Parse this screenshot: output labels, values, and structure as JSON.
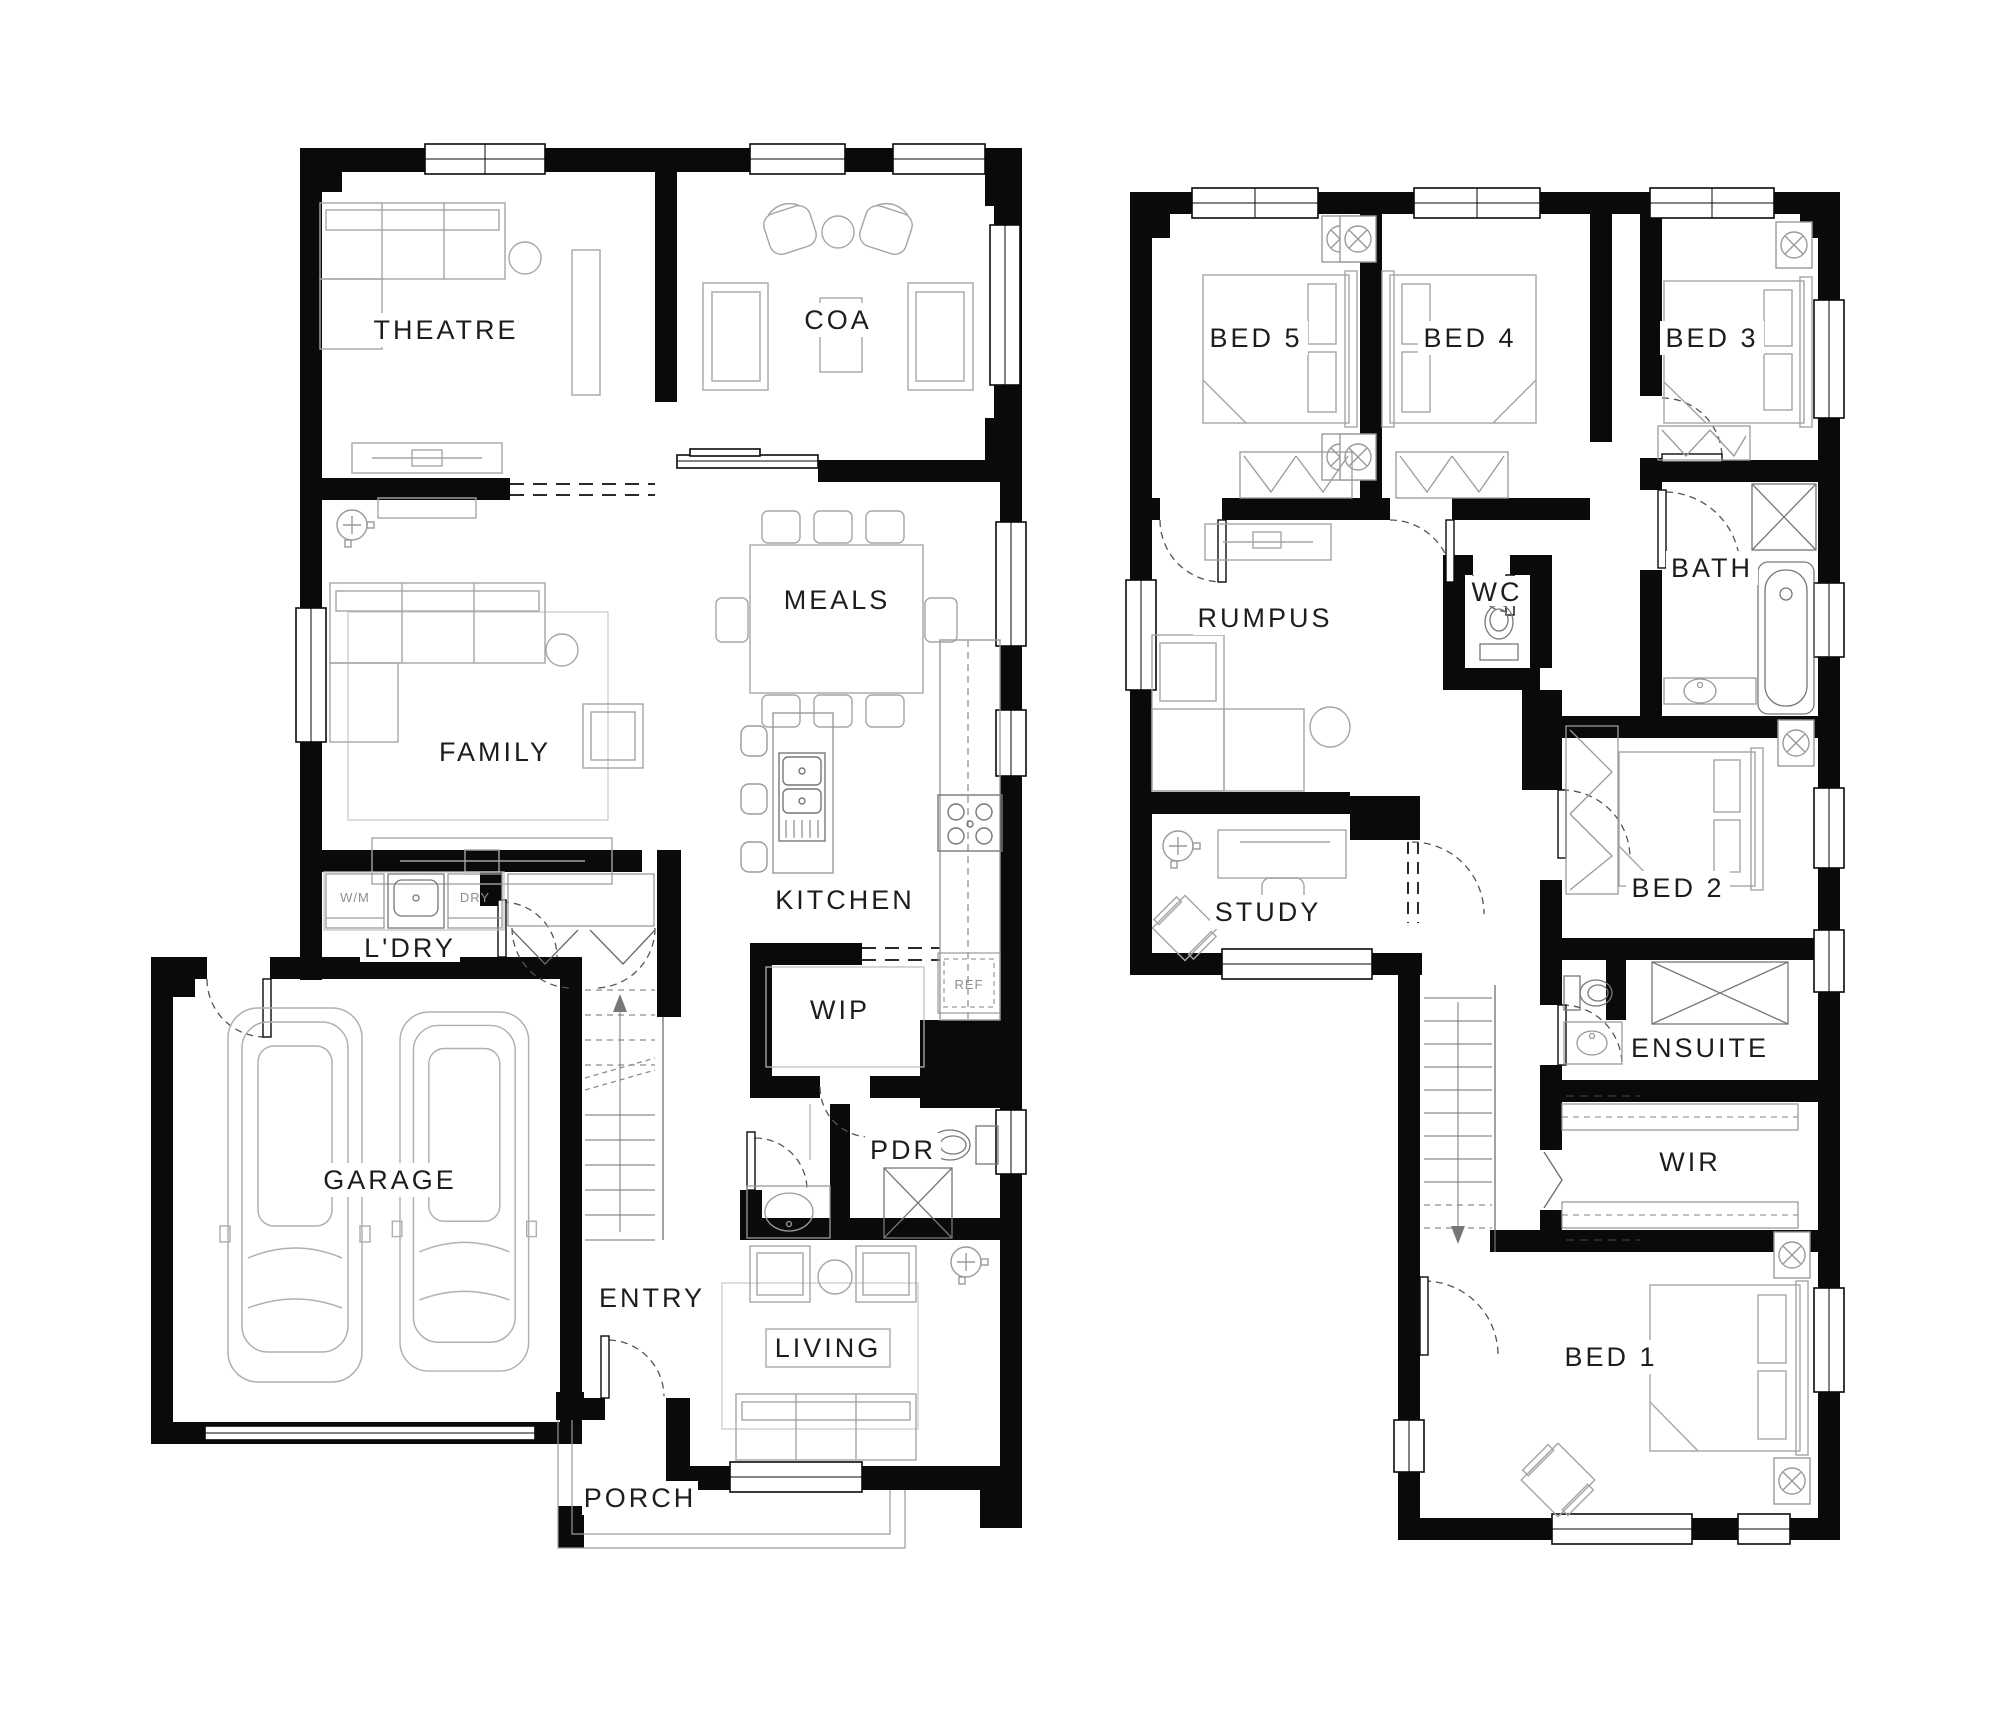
{
  "page": {
    "type": "architectural-floor-plan",
    "background_color": "#ffffff",
    "wall_color": "#0a0a0a",
    "furniture_line_color": "#9a9a9a",
    "label_color": "#1d1d1d"
  },
  "plans": {
    "ground": {
      "rooms": {
        "theatre": "THEATRE",
        "coa": "COA",
        "meals": "MEALS",
        "family": "FAMILY",
        "kitchen": "KITCHEN",
        "laundry": "L'DRY",
        "wip": "WIP",
        "pdr": "PDR",
        "garage": "GARAGE",
        "entry": "ENTRY",
        "living": "LIVING",
        "porch": "PORCH"
      },
      "appliances": {
        "washer": "W/M",
        "dryer": "DRY",
        "fridge": "REF"
      }
    },
    "first": {
      "rooms": {
        "bed5": "BED 5",
        "bed4": "BED 4",
        "bed3": "BED 3",
        "bath": "BATH",
        "wc": "WC",
        "rumpus": "RUMPUS",
        "bed2": "BED 2",
        "study": "STUDY",
        "ensuite": "ENSUITE",
        "wir": "WIR",
        "bed1": "BED 1"
      }
    }
  }
}
